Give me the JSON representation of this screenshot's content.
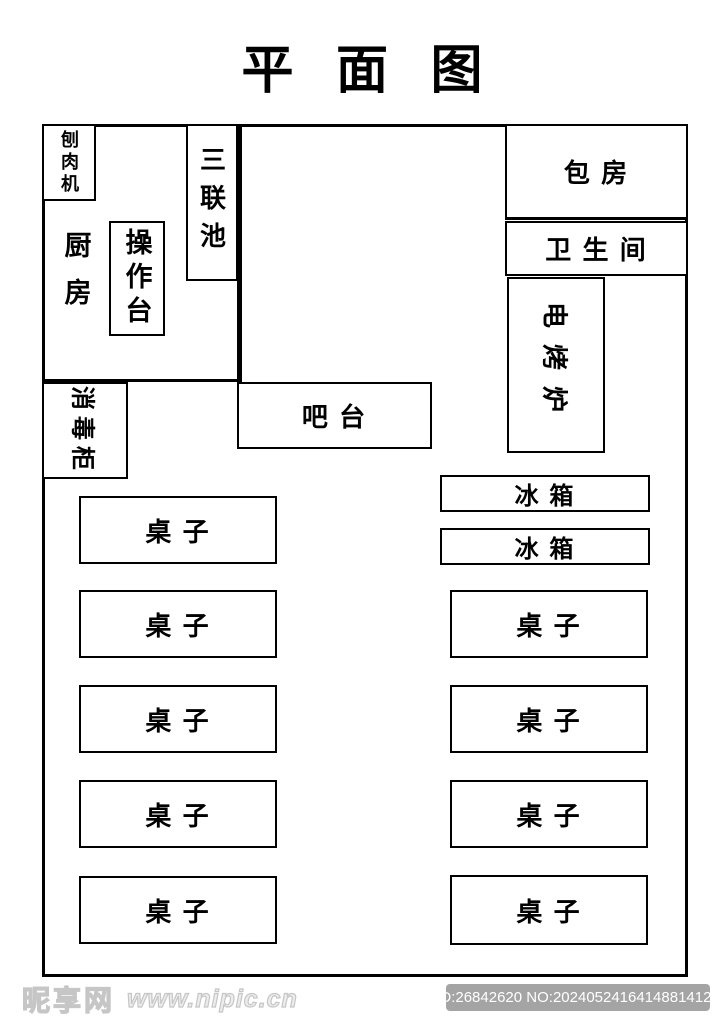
{
  "title": "平 面 图",
  "plan": {
    "meat_slicer": "刨肉机",
    "triple_sink": "三联池",
    "kitchen": "厨房",
    "prep_counter": "操作台",
    "private_room": "包 房",
    "restroom": "卫 生 间",
    "electric_oven": "电烤炉",
    "disinfection_cabinet": "消毒柜",
    "bar_counter": "吧 台",
    "fridge": "冰 箱",
    "table": "桌 子",
    "left_table_count": 5,
    "right_table_count": 4,
    "fridge_count": 2
  },
  "colors": {
    "wall_line": "#000000",
    "background": "#ffffff",
    "badge_bg": "#a4a4a4",
    "badge_text": "#ffffff",
    "watermark_outline": "#c6c6c6"
  },
  "footer": {
    "watermark_logo": "昵享网",
    "watermark_url": "www.nipic.cn",
    "id_badge": "ID:26842620 NO:20240524164148814128"
  }
}
